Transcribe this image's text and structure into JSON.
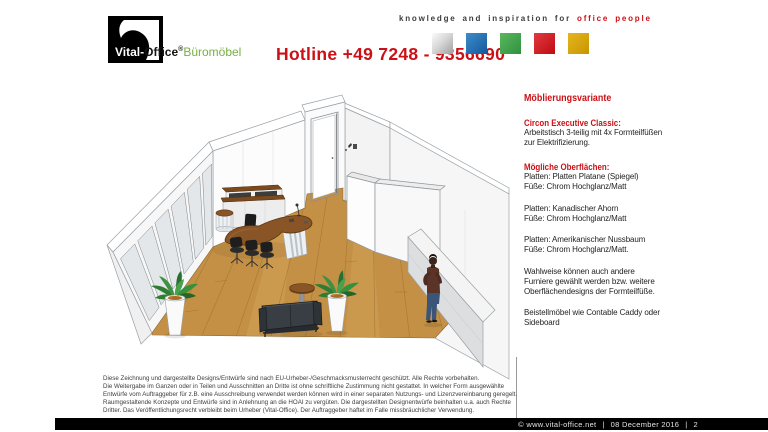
{
  "header": {
    "logo": {
      "white": "Vital-",
      "black": "Office",
      "reg": "®",
      "green": "Büromöbel"
    },
    "hotline": "Hotline +49 7248 - 9356690",
    "tagline": {
      "prefix": "knowledge and inspiration for",
      "highlight": "office people"
    },
    "squares": [
      {
        "name": "silver",
        "color": "#c0c0c0"
      },
      {
        "name": "blue",
        "color": "#1e6fb5"
      },
      {
        "name": "green",
        "color": "#3fa648"
      },
      {
        "name": "red",
        "color": "#d11018"
      },
      {
        "name": "gold",
        "color": "#d8a400"
      }
    ]
  },
  "colors": {
    "brand_red": "#cc1016",
    "brand_green": "#76b043"
  },
  "illustration": {
    "label": "3D rendering of an office room with executive desk, visitor chairs, sofa, sideboard and plants"
  },
  "sidebar": {
    "title": "Möblierungsvariante",
    "sections": [
      {
        "heading": "Circon Executive Classic:",
        "lines": [
          "Arbeitstisch 3-teilig mit 4x Formteilfüßen",
          "zur Elektrifizierung."
        ]
      },
      {
        "heading": "Mögliche Oberflächen:",
        "lines": [
          "Platten: Platten Platane (Spiegel)",
          "Füße: Chrom Hochglanz/Matt"
        ]
      },
      {
        "heading": "",
        "lines": [
          "Platten: Kanadischer Ahorn",
          "Füße: Chrom Hochglanz/Matt"
        ]
      },
      {
        "heading": "",
        "lines": [
          "Platten: Amerikanischer Nussbaum",
          "Füße: Chrom Hochglanz/Matt."
        ]
      },
      {
        "heading": "",
        "lines": [
          "Wahlweise können auch andere",
          "Furniere gewählt werden bzw. weitere",
          "Oberflächendesigns der Formteilfüße."
        ]
      },
      {
        "heading": "",
        "lines": [
          "Beistellmöbel wie Contable Caddy oder",
          "Sideboard"
        ]
      }
    ]
  },
  "disclaimer": {
    "lines": [
      "Diese Zeichnung und dargestellte Designs/Entwürfe sind nach EU-Urheber-/Geschmacksmusterrecht geschützt. Alle Rechte vorbehalten.",
      "Die Weitergabe im Ganzen oder in Teilen und Ausschnitten an Dritte ist ohne schriftliche Zustimmung nicht gestattet. In welcher Form ausgewählte",
      "Entwürfe vom Auftraggeber für z.B. eine Ausschreibung verwendet werden können wird in einer separaten Nutzungs- und Lizenzvereinbarung geregelt.",
      "Raumgestaltende Konzepte und Entwürfe sind in Anlehnung an die HOAI zu vergüten. Die dargestellten Designentwürfe beinhalten u.a. auch Rechte",
      "Dritter. Das Veröffentlichungsrecht verbleibt beim Urheber (Vital-Office). Der Auftraggeber haftet im Falle missbräuchlicher Verwendung."
    ]
  },
  "footer": {
    "copyright": "©  www.vital-office.net",
    "separator": "|",
    "date": "08 December 2016",
    "page": "2"
  }
}
